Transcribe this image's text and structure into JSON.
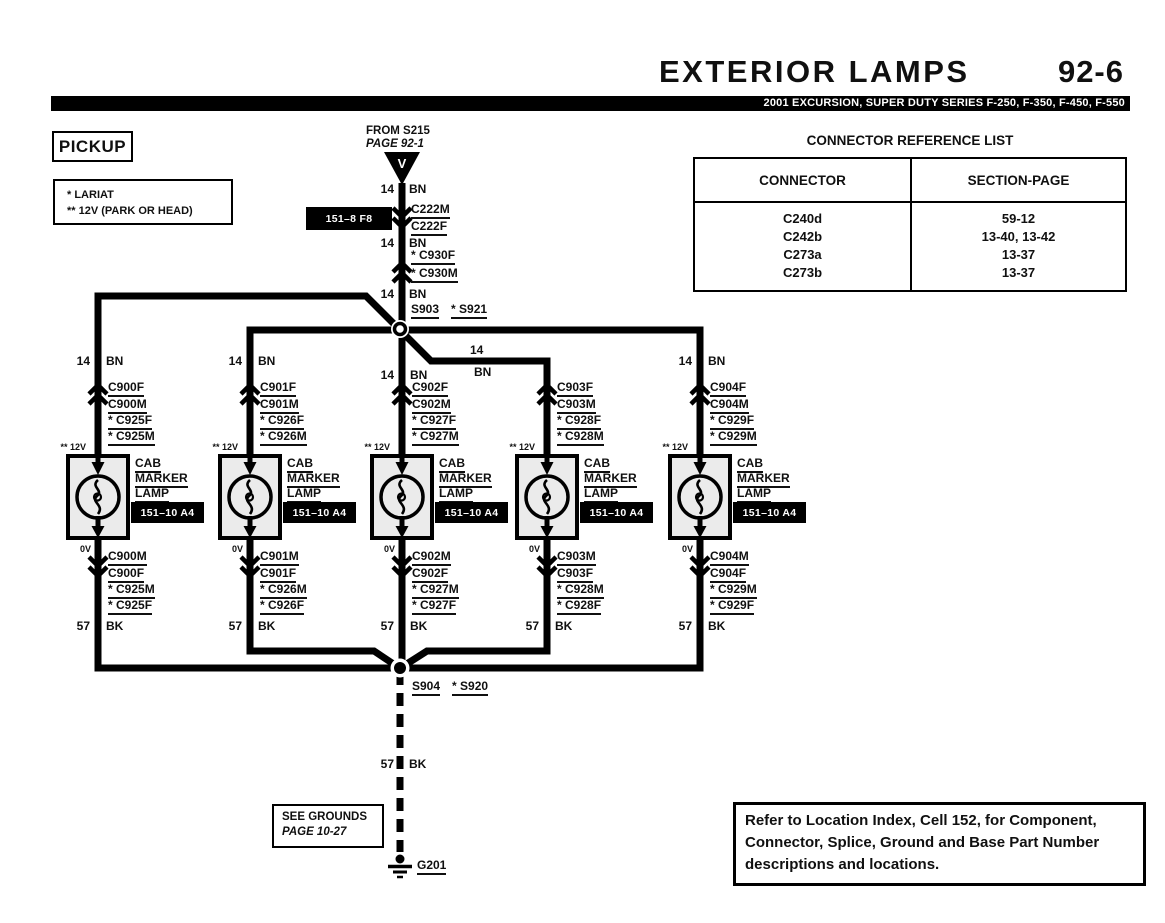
{
  "page": {
    "title": "EXTERIOR LAMPS",
    "page_number": "92-6",
    "models_bar": "2001 EXCURSION, SUPER DUTY SERIES F-250, F-350, F-450, F-550",
    "variant": "PICKUP",
    "legend": {
      "line1": "* LARIAT",
      "line2": "** 12V (PARK OR HEAD)"
    },
    "footer_note": "Refer to Location Index, Cell 152, for Component, Connector, Splice, Ground and Base Part Number descriptions and locations."
  },
  "connector_table": {
    "title": "CONNECTOR REFERENCE LIST",
    "col_connector": "CONNECTOR",
    "col_section_page": "SECTION-PAGE",
    "rows": [
      {
        "connector": "C240d",
        "section_page": "59-12"
      },
      {
        "connector": "C242b",
        "section_page": "13-40, 13-42"
      },
      {
        "connector": "C273a",
        "section_page": "13-37"
      },
      {
        "connector": "C273b",
        "section_page": "13-37"
      }
    ]
  },
  "feed": {
    "source_line1": "FROM S215",
    "source_line2": "PAGE 92-1",
    "arrow_letter": "V",
    "seg1_gauge": "14",
    "seg1_color": "BN",
    "conn1_top": "C222M",
    "conn1_bottom": "C222F",
    "conn1_cell": "151–8 F8",
    "seg2_gauge": "14",
    "seg2_color": "BN",
    "conn2_top": "* C930F",
    "conn2_bottom": "* C930M",
    "seg3_gauge": "14",
    "seg3_color": "BN",
    "splice_label": "S903",
    "splice_alt": "* S921",
    "branch4_gauge": "14",
    "branch4_color": "BN"
  },
  "branches": [
    {
      "gauge": "14",
      "color": "BN",
      "conn_top": [
        "C900F",
        "C900M",
        "* C925F",
        "* C925M"
      ],
      "volt_top": "** 12V",
      "volt_bottom": "0V",
      "comp1": "CAB",
      "comp2": "MARKER",
      "comp3": "LAMP",
      "cell": "151–10 A4",
      "conn_bottom": [
        "C900M",
        "C900F",
        "* C925M",
        "* C925F"
      ],
      "gauge_bottom": "57",
      "color_bottom": "BK"
    },
    {
      "gauge": "14",
      "color": "BN",
      "conn_top": [
        "C901F",
        "C901M",
        "* C926F",
        "* C926M"
      ],
      "volt_top": "** 12V",
      "volt_bottom": "0V",
      "comp1": "CAB",
      "comp2": "MARKER",
      "comp3": "LAMP",
      "cell": "151–10 A4",
      "conn_bottom": [
        "C901M",
        "C901F",
        "* C926M",
        "* C926F"
      ],
      "gauge_bottom": "57",
      "color_bottom": "BK"
    },
    {
      "gauge": "14",
      "color": "BN",
      "conn_top": [
        "C902F",
        "C902M",
        "* C927F",
        "* C927M"
      ],
      "volt_top": "** 12V",
      "volt_bottom": "0V",
      "comp1": "CAB",
      "comp2": "MARKER",
      "comp3": "LAMP",
      "cell": "151–10 A4",
      "conn_bottom": [
        "C902M",
        "C902F",
        "* C927M",
        "* C927F"
      ],
      "gauge_bottom": "57",
      "color_bottom": "BK"
    },
    {
      "conn_top": [
        "C903F",
        "C903M",
        "* C928F",
        "* C928M"
      ],
      "volt_top": "** 12V",
      "volt_bottom": "0V",
      "comp1": "CAB",
      "comp2": "MARKER",
      "comp3": "LAMP",
      "cell": "151–10 A4",
      "conn_bottom": [
        "C903M",
        "C903F",
        "* C928M",
        "* C928F"
      ],
      "gauge_bottom": "57",
      "color_bottom": "BK"
    },
    {
      "gauge": "14",
      "color": "BN",
      "conn_top": [
        "C904F",
        "C904M",
        "* C929F",
        "* C929M"
      ],
      "volt_top": "** 12V",
      "volt_bottom": "0V",
      "comp1": "CAB",
      "comp2": "MARKER",
      "comp3": "LAMP",
      "cell": "151–10 A4",
      "conn_bottom": [
        "C904M",
        "C904F",
        "* C929M",
        "* C929F"
      ],
      "gauge_bottom": "57",
      "color_bottom": "BK"
    }
  ],
  "ground_path": {
    "splice_label": "S904",
    "splice_alt": "* S920",
    "gauge": "57",
    "color": "BK",
    "note_line1": "SEE GROUNDS",
    "note_line2": "PAGE 10-27",
    "ground_id": "G201"
  },
  "colors": {
    "line": "#000000",
    "lamp_fill": "#ebebeb",
    "bar_bg": "#000000",
    "bar_text": "#ffffff"
  }
}
